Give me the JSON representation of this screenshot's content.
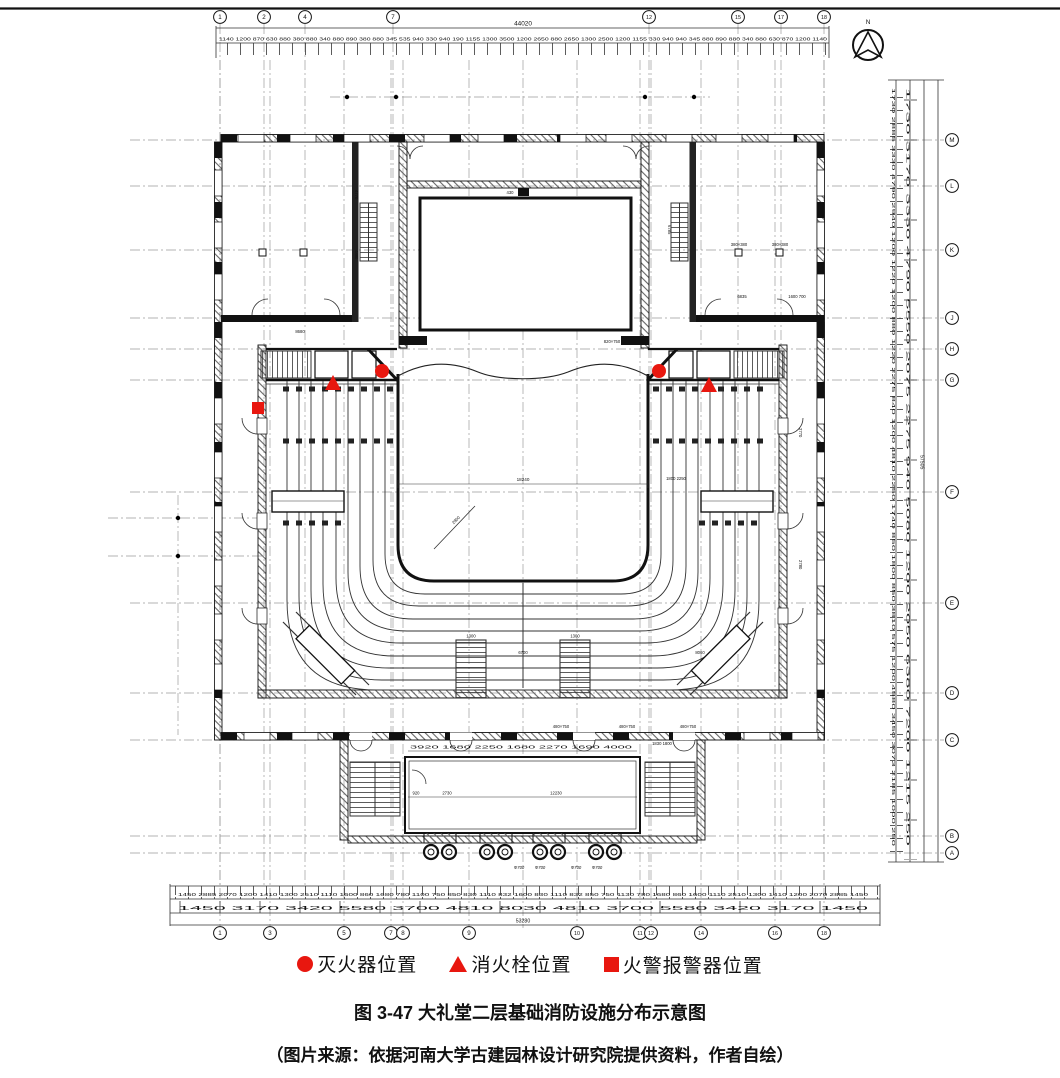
{
  "figure": {
    "caption": "图 3-47 大礼堂二层基础消防设施分布示意图",
    "source": "（图片来源：依据河南大学古建园林设计研究院提供资料，作者自绘）"
  },
  "legend": {
    "items": [
      {
        "shape": "circle",
        "color": "#e8170f",
        "label": "灭火器位置"
      },
      {
        "shape": "triangle",
        "color": "#e8170f",
        "label": "消火栓位置"
      },
      {
        "shape": "square",
        "color": "#e8170f",
        "label": "火警报警器位置"
      }
    ]
  },
  "north_label": "N",
  "colors": {
    "marker_red": "#e8170f",
    "line": "#111111",
    "grid_gray": "#9b9b9b"
  },
  "grid": {
    "top": [
      {
        "label": "1",
        "x": 220
      },
      {
        "label": "2",
        "x": 264
      },
      {
        "label": "4",
        "x": 305
      },
      {
        "label": "7",
        "x": 393
      },
      {
        "label": "12",
        "x": 649
      },
      {
        "label": "15",
        "x": 738
      },
      {
        "label": "17",
        "x": 781
      },
      {
        "label": "18",
        "x": 824
      }
    ],
    "bottom": [
      {
        "label": "1",
        "x": 220
      },
      {
        "label": "3",
        "x": 270
      },
      {
        "label": "5",
        "x": 344
      },
      {
        "label": "7",
        "x": 391
      },
      {
        "label": "8",
        "x": 403
      },
      {
        "label": "9",
        "x": 469
      },
      {
        "label": "10",
        "x": 577
      },
      {
        "label": "11",
        "x": 640
      },
      {
        "label": "12",
        "x": 651
      },
      {
        "label": "14",
        "x": 701
      },
      {
        "label": "16",
        "x": 775
      },
      {
        "label": "18",
        "x": 824
      }
    ],
    "right": [
      {
        "label": "M",
        "y": 140
      },
      {
        "label": "L",
        "y": 186
      },
      {
        "label": "K",
        "y": 250
      },
      {
        "label": "J",
        "y": 318
      },
      {
        "label": "H",
        "y": 349
      },
      {
        "label": "G",
        "y": 380
      },
      {
        "label": "F",
        "y": 492
      },
      {
        "label": "E",
        "y": 603
      },
      {
        "label": "D",
        "y": 693
      },
      {
        "label": "C",
        "y": 740
      },
      {
        "label": "B",
        "y": 836
      },
      {
        "label": "A",
        "y": 853
      }
    ]
  },
  "markers": [
    {
      "type": "extinguisher",
      "x": 382,
      "y": 371
    },
    {
      "type": "hydrant",
      "x": 333,
      "y": 384
    },
    {
      "type": "alarm",
      "x": 258,
      "y": 408
    },
    {
      "type": "extinguisher",
      "x": 659,
      "y": 371
    },
    {
      "type": "hydrant",
      "x": 709,
      "y": 386
    }
  ],
  "dimensions": {
    "top_total": "44020",
    "top_row": "1140 1200 870 630 880 380 880 340 880 890 380 880 345 535 940 330 940 190 1155 1300 3500 1200 2650 880 2650 1300 2500 1200 1155 330 940 940 345 880 890 880 340 880 630 870 1200 1140",
    "bottom_row_small": "1450 2885 2070 1200 1410 1300 2510 1110 1600 860 1680 780 1100 750 850 830 1110 832 1600 830 1110 832 850 750 1130 780 1680 860 1600 1110 2510 1300 1410 1200 2070 2885 1450",
    "bottom_row_main": "1450 3170 3420 5580 3700 4810 8030 4810 3700 5580 3420 3170 1450",
    "bottom_total": "53280",
    "right_col_a": "1730 2885 3330 4790 2940 1200 1220 1200 880 1220 2275 840 1200 4810 2250 1740 850 1800 850 3810 575 1200 4580 3450 3073 2185 1000 250",
    "right_col_b": "1730 3170 3330 4790 5550 2075 2275 940 5080 1200 2050 6380 7200 1215 250",
    "right_total": "57505",
    "hall_width": "18240",
    "lobby_top_row": "3920 1680 2250 1680 2270 1690 4000",
    "lobby_door": "920",
    "lobby_left": "2730",
    "lobby_width": "12230",
    "lobby_right_top": "1830 1800",
    "wing_left_width": "8680",
    "wing_right_width": "6835",
    "wing_right_door": "1600 700",
    "aisle_gap": "6700",
    "aisle_width": "1300",
    "aisle_width2": "1300",
    "right_bank_width": "8060",
    "right_bank_top": "1800 2250",
    "diag_label": "2800",
    "stage_tick": "430",
    "wing_stair_a": "4770",
    "wing_stair_b": "4880",
    "backstage_stair": "6785",
    "column_label": "380×380",
    "door_label_a": "820×750",
    "door_label_b": "480×750",
    "corridor_a": "2770",
    "corridor_b": "2780",
    "porch_column": "Φ700"
  }
}
